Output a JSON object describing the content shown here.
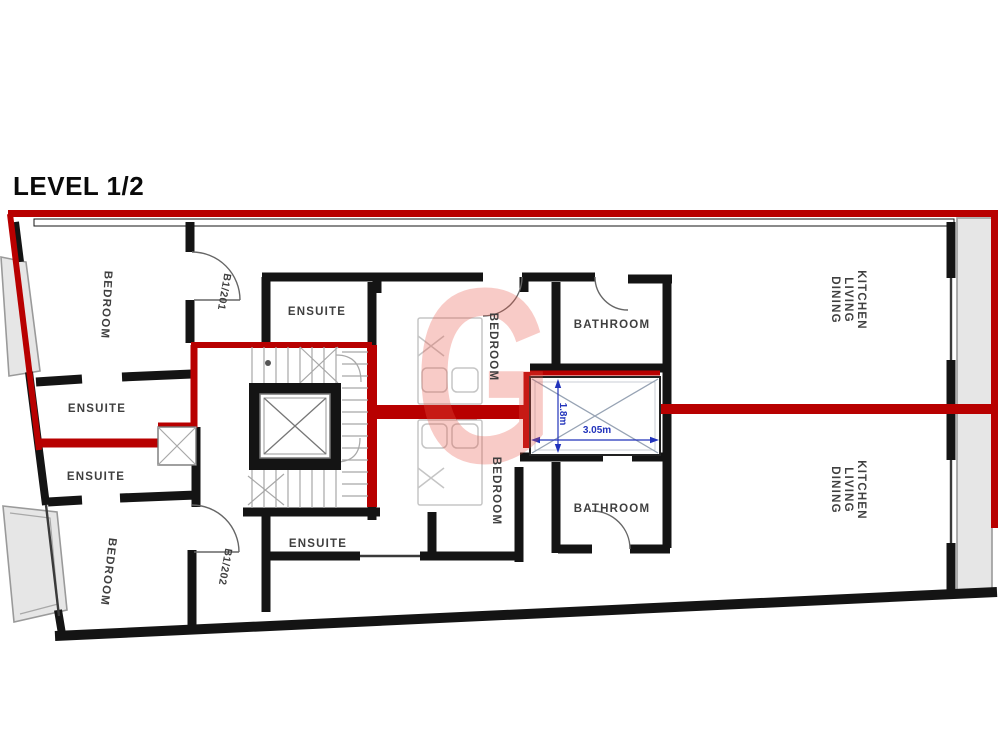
{
  "title": "LEVEL 1/2",
  "watermark_letter": "G",
  "units": {
    "upper": "B1/201",
    "lower": "B1/202"
  },
  "rooms": {
    "bedroom_top_left": "BEDROOM",
    "bedroom_bottom_left": "BEDROOM",
    "bedroom_mid_upper": "BEDROOM",
    "bedroom_mid_lower": "BEDROOM",
    "ensuite_top_center": "ENSUITE",
    "ensuite_left_1": "ENSUITE",
    "ensuite_left_2": "ENSUITE",
    "ensuite_bottom_center": "ENSUITE",
    "bathroom_top": "BATHROOM",
    "bathroom_bottom": "BATHROOM"
  },
  "kitchen_living_dining": {
    "line1": "KITCHEN",
    "line2": "LIVING",
    "line3": "DINING"
  },
  "dimensions": {
    "shaft_width": "3.05m",
    "shaft_depth": "1.8m"
  },
  "colors": {
    "accent_red": "#b80000",
    "wall_black": "#141414",
    "dim_blue": "#2233bb",
    "balcony_gray": "#e6e6e6",
    "watermark_pink": "#ea5648"
  }
}
